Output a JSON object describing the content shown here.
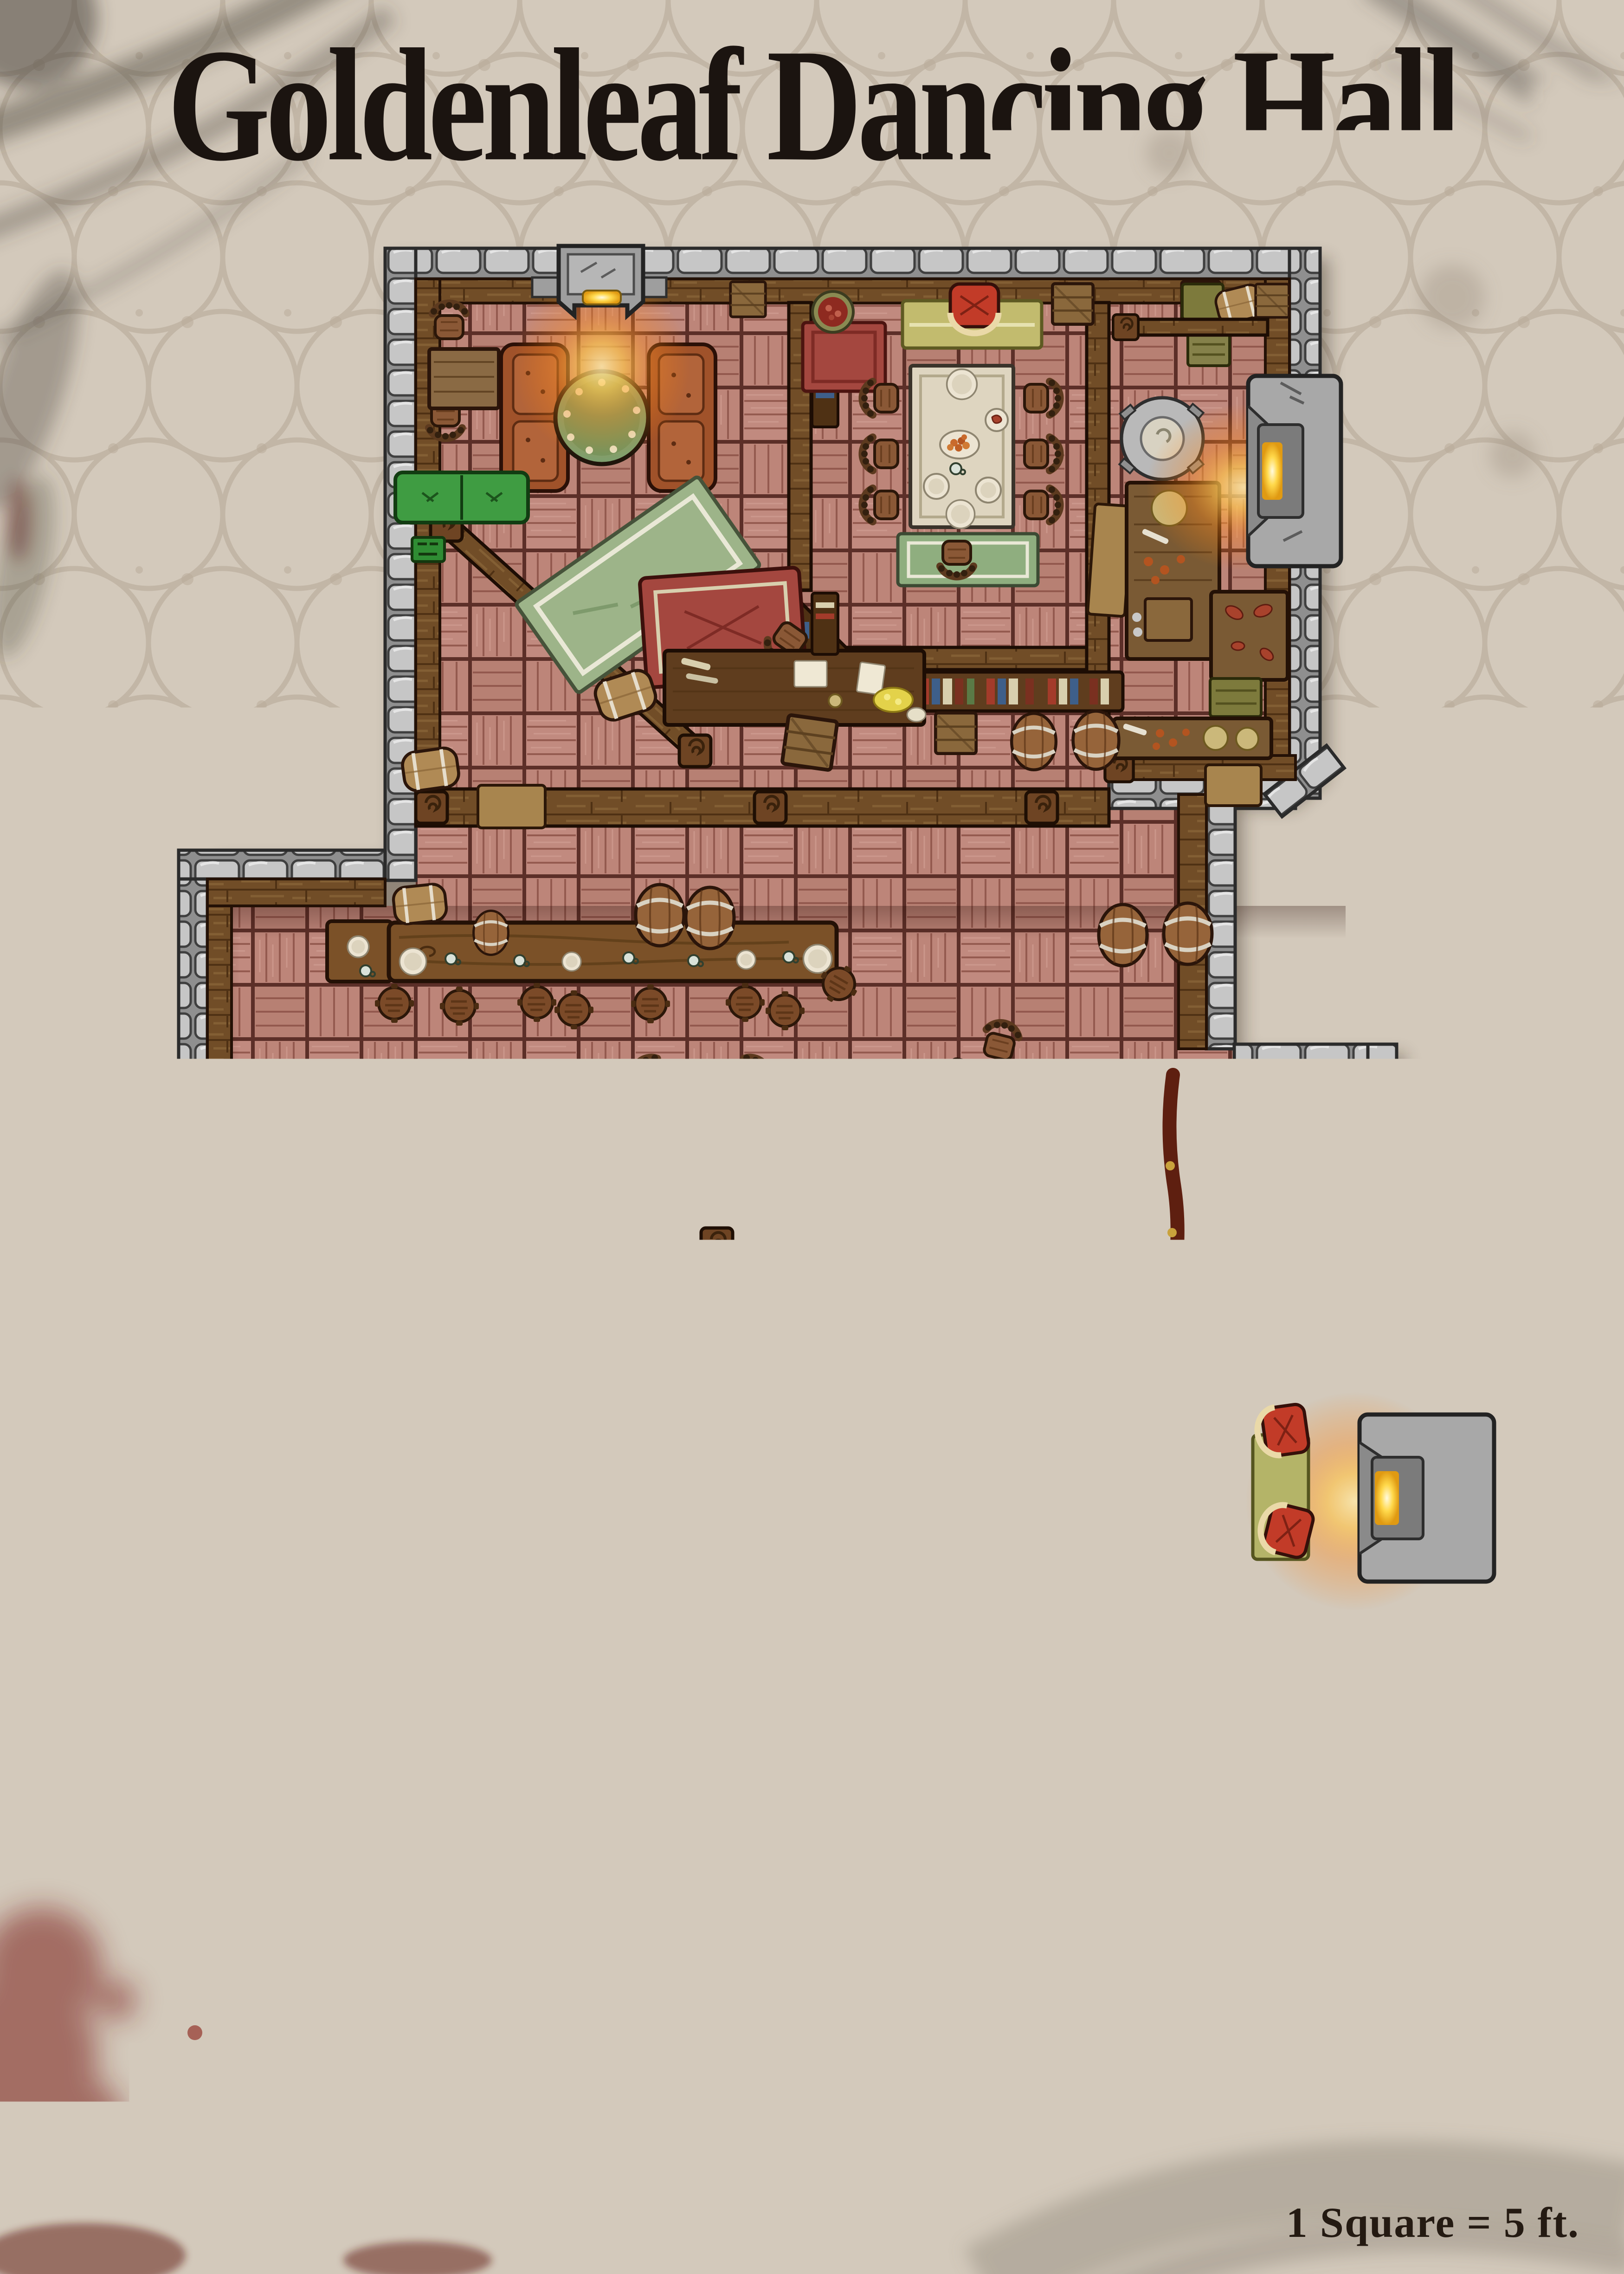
{
  "page": {
    "title": "Goldenleaf Dancing Hall",
    "scale_note": "1 Square = 5 ft."
  },
  "theme": {
    "colors": {
      "ink": "#1b1410",
      "parchment": "#d3c9bb",
      "parchment_pattern": "#b7a998",
      "floor_parquet": "#bd8579",
      "floor_line": "#5c2f28",
      "wall_stone": "#c6c6c6",
      "wall_wood": "#714d27",
      "dance_floor": "#a6a6a6",
      "stage_wood": "#cec4b0",
      "torch_glow": "#ff8c1e",
      "fire_core": "#ffd84a",
      "rug_green": "#8fae7f",
      "bench_green": "#3f9c42",
      "leather_couch": "#a0522a",
      "armchair_red": "#c23b28",
      "tablecloth": "#ded5c0",
      "blood_splatter": "#7c241a",
      "grunge_gray": "#4a443c"
    }
  },
  "icons": {
    "torch_stand": "glowing-candle-stand-icon",
    "wall_torch": "wall-lantern-icon",
    "fireplace": "hearth-icon",
    "statue": "stone-statue-icon"
  }
}
